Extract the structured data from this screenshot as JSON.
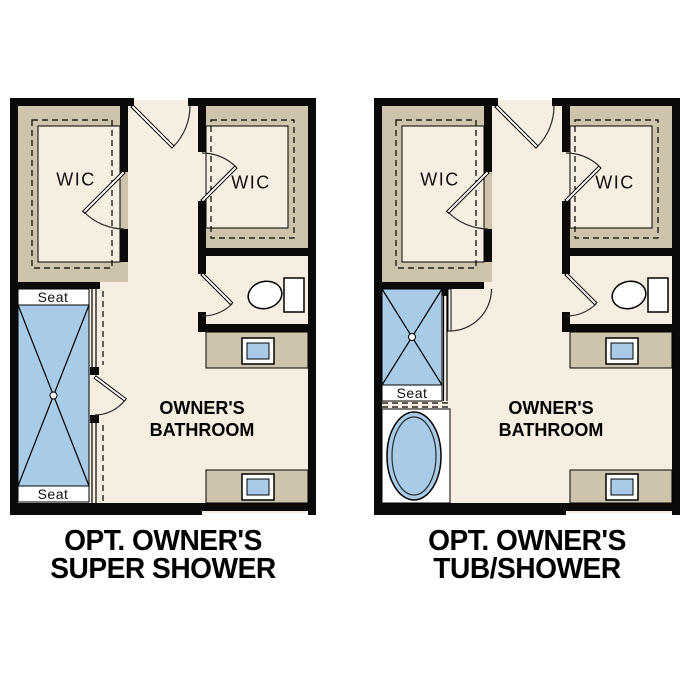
{
  "colors": {
    "floor-color": "#f5eee1",
    "shelf-color": "#cec4ab",
    "fixture-color": "#a8cbe8",
    "wall-color": "#0a0a0a"
  },
  "plans": [
    {
      "id": "super-shower",
      "title": {
        "line1": "OPT. OWNER'S",
        "line2": "SUPER SHOWER"
      },
      "rooms": {
        "wic_left": "WIC",
        "wic_right": "WIC",
        "bathroom_line1": "OWNER'S",
        "bathroom_line2": "BATHROOM"
      },
      "fixtures": {
        "seat_top": "Seat",
        "seat_bottom": "Seat"
      }
    },
    {
      "id": "tub-shower",
      "title": {
        "line1": "OPT. OWNER'S",
        "line2": "TUB/SHOWER"
      },
      "rooms": {
        "wic_left": "WIC",
        "wic_right": "WIC",
        "bathroom_line1": "OWNER'S",
        "bathroom_line2": "BATHROOM"
      },
      "fixtures": {
        "seat": "Seat"
      }
    }
  ]
}
